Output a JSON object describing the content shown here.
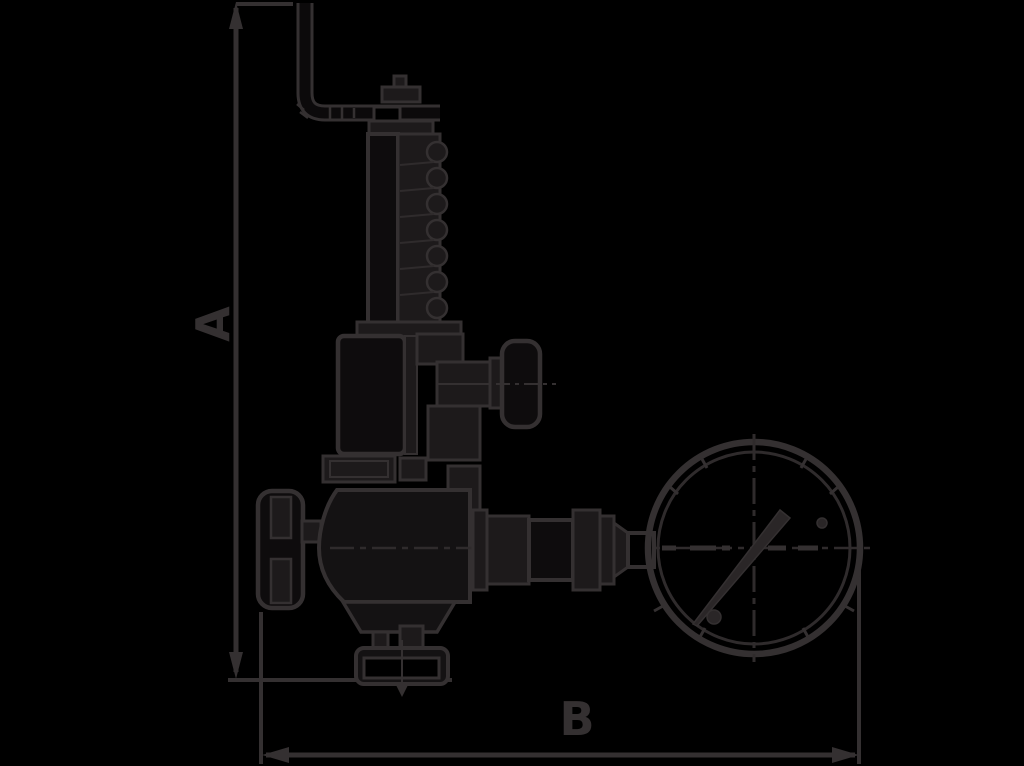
{
  "diagram": {
    "background_color": "#000000",
    "line_color": "#343031",
    "fill_color": "#1d1a1b",
    "dimensions": {
      "vertical": {
        "label": "A"
      },
      "horizontal": {
        "label": "B"
      }
    },
    "components": [
      "test-lever-pipe",
      "spring-housing",
      "bonnet",
      "side-outlet-knob",
      "handwheel",
      "valve-body",
      "bottom-flange",
      "gauge-connection-piping",
      "pressure-gauge"
    ]
  }
}
